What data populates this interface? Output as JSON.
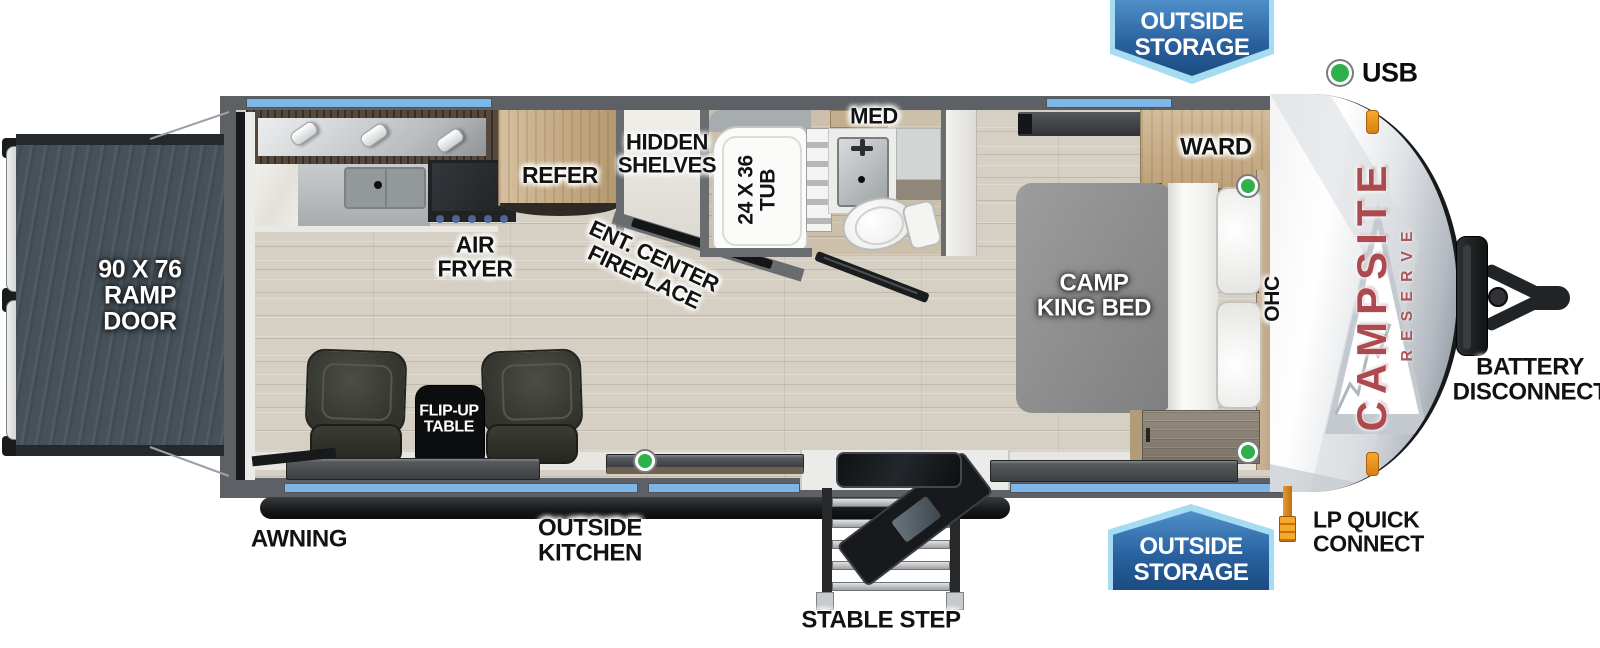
{
  "type": "rv-floorplan-diagram",
  "banners": {
    "top_outside_storage": "OUTSIDE\nSTORAGE",
    "bottom_outside_storage": "OUTSIDE\nSTORAGE"
  },
  "legend": {
    "usb": "USB"
  },
  "brand": {
    "name": "CAMPSITE",
    "series": "RESERVE"
  },
  "labels": {
    "ramp_door": "90 X 76\nRAMP\nDOOR",
    "refer": "REFER",
    "hidden_shelves": "HIDDEN\nSHELVES",
    "ent_center_fireplace": "ENT. CENTER\nFIREPLACE",
    "air_fryer": "AIR\nFRYER",
    "tub": "24 X 36\nTUB",
    "med": "MED",
    "camp_king_bed": "CAMP\nKING BED",
    "ward": "WARD",
    "ohc": "OHC",
    "flip_up_table": "FLIP-UP\nTABLE",
    "awning": "AWNING",
    "outside_kitchen": "OUTSIDE\nKITCHEN",
    "stable_step": "STABLE STEP",
    "lp_quick_connect": "LP QUICK\nCONNECT",
    "battery_disconnect": "BATTERY\nDISCONNECT"
  },
  "colors": {
    "banner_border": "#a5dcf2",
    "banner_blue_top": "#4f8fca",
    "banner_blue_bottom": "#1b4b80",
    "window_strip_blue": "#7db7e8",
    "usb_green": "#2eb04b",
    "brand_red": "#ad4a4f",
    "wall_gray": "#5d6165",
    "floor_wood": "#d6cfc3",
    "ramp_slate": "#46515a",
    "lp_orange": "#e89a2e"
  }
}
